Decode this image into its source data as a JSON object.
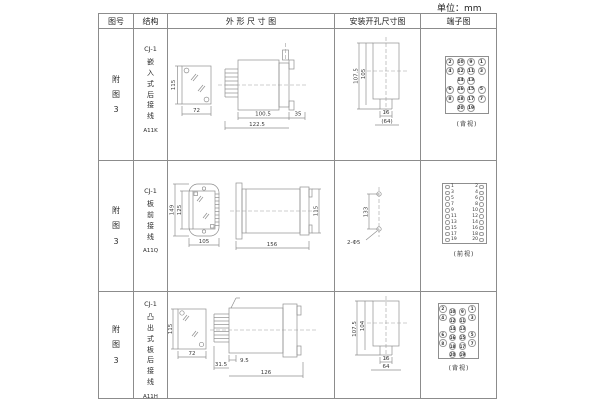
{
  "unit_label": "单位：mm",
  "header": {
    "figure": "图号",
    "structure": "结构",
    "outline": "外 形 尺 寸 图",
    "mounting": "安装开孔尺寸图",
    "terminal": "端子图"
  },
  "rows": [
    {
      "figure": "附图3",
      "structure": {
        "model": "CJ-1",
        "desc": "嵌入式后接线",
        "code": "A11K"
      },
      "outline": {
        "front_height": "115",
        "front_width": "72",
        "side_d1": "100.5",
        "side_d2": "122.5",
        "side_d3": "35"
      },
      "mounting": {
        "d1": "107.5",
        "d2": "105",
        "d3": "16",
        "d4": "(64)"
      },
      "terminal": {
        "caption": "(背视)",
        "grid": [
          [
            "2",
            "10",
            "9",
            "1"
          ],
          [
            "4",
            "12",
            "11",
            "3"
          ],
          [
            "",
            "14",
            "13",
            ""
          ],
          [
            "6",
            "16",
            "15",
            "5"
          ],
          [
            "8",
            "18",
            "17",
            "7"
          ],
          [
            "",
            "20",
            "19",
            ""
          ]
        ]
      }
    },
    {
      "figure": "附图3",
      "structure": {
        "model": "CJ-1",
        "desc": "板前接线",
        "code": "A11Q"
      },
      "outline": {
        "front_h1": "149",
        "front_h2": "125",
        "front_w": "105",
        "side_len": "156",
        "side_h": "115"
      },
      "mounting": {
        "spacing": "133",
        "holes": "2-Φ5"
      },
      "terminal": {
        "caption": "(前视)",
        "left": [
          "1",
          "3",
          "5",
          "7",
          "9",
          "11",
          "13",
          "15",
          "17",
          "19"
        ],
        "right": [
          "2",
          "4",
          "6",
          "8",
          "10",
          "12",
          "14",
          "16",
          "18",
          "20"
        ]
      }
    },
    {
      "figure": "附图3",
      "structure": {
        "model": "CJ-1",
        "desc": "凸出式板后接线",
        "code": "A11H"
      },
      "outline": {
        "front_height": "115",
        "front_width": "72",
        "side_d1": "31.5",
        "side_d2": "9.5",
        "side_d3": "126"
      },
      "mounting": {
        "d1": "107.5",
        "d2": "104",
        "d3": "16",
        "d4": "64"
      },
      "terminal": {
        "caption": "(背视)",
        "grid": [
          [
            "2",
            "10",
            "9",
            "1"
          ],
          [
            "4",
            "12",
            "11",
            "3"
          ],
          [
            "",
            "14",
            "13",
            ""
          ],
          [
            "6",
            "16",
            "15",
            "5"
          ],
          [
            "8",
            "18",
            "17",
            "7"
          ],
          [
            "",
            "20",
            "19",
            ""
          ]
        ]
      }
    }
  ]
}
